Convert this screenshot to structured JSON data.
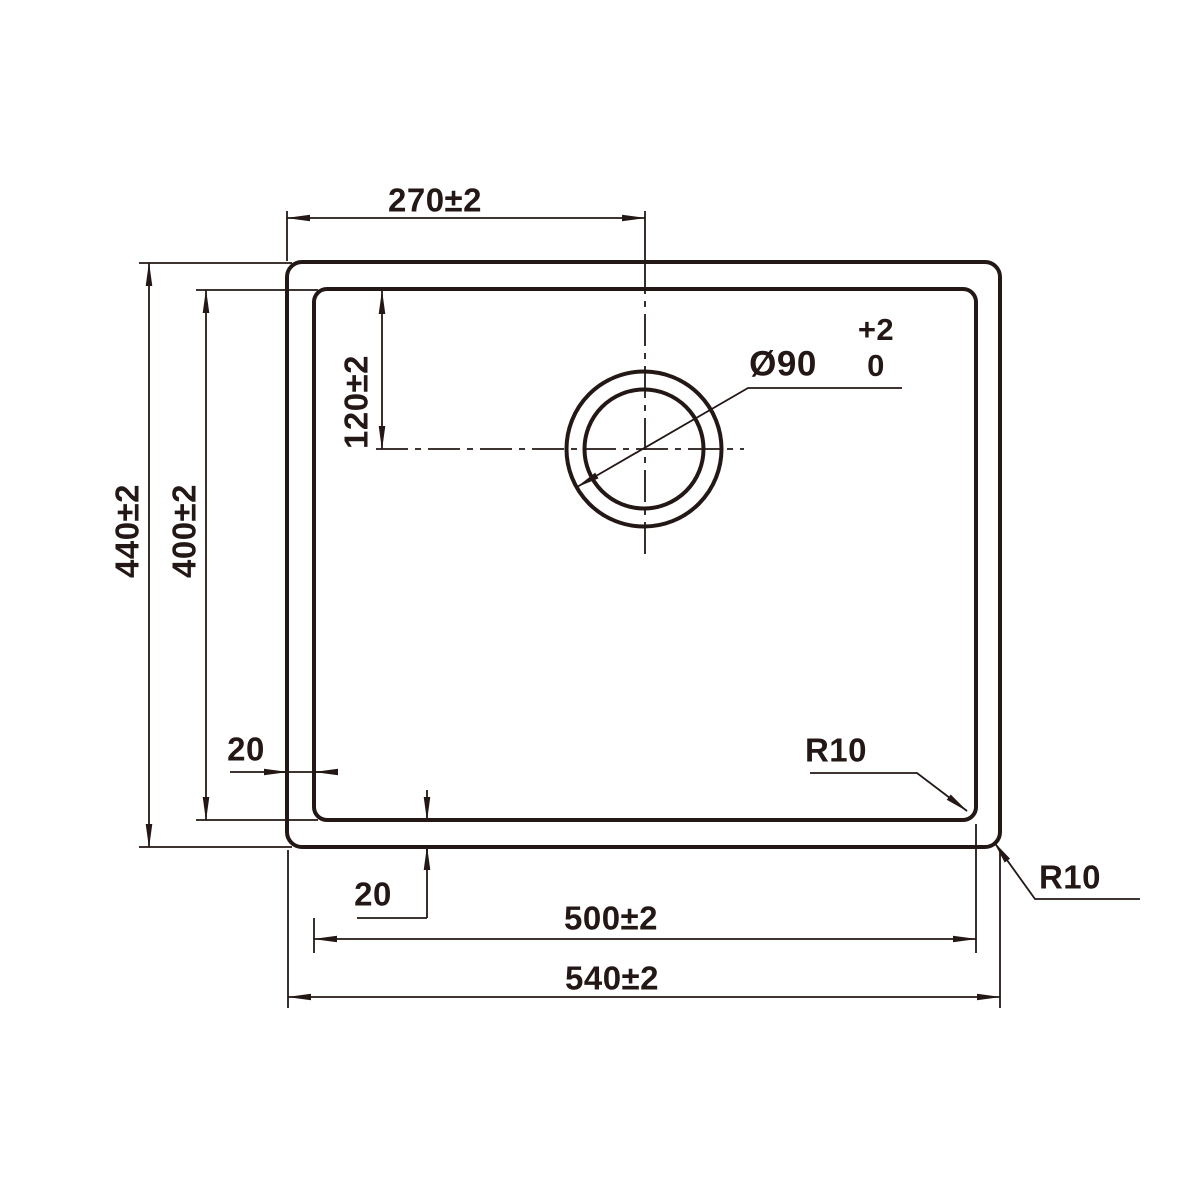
{
  "colors": {
    "line": "#231815",
    "background": "#ffffff"
  },
  "dimensions": {
    "drain_offset_horizontal": "270±2",
    "drain_offset_vertical": "120±2",
    "overall_height": "440±2",
    "inner_height": "400±2",
    "left_edge_gap": "20",
    "bottom_edge_gap": "20",
    "inner_width": "500±2",
    "overall_width": "540±2",
    "drain_diameter": "Ø90",
    "drain_tolerance_upper": "+2",
    "drain_tolerance_lower": "0",
    "inner_corner_radius": "R10",
    "outer_corner_radius": "R10"
  }
}
